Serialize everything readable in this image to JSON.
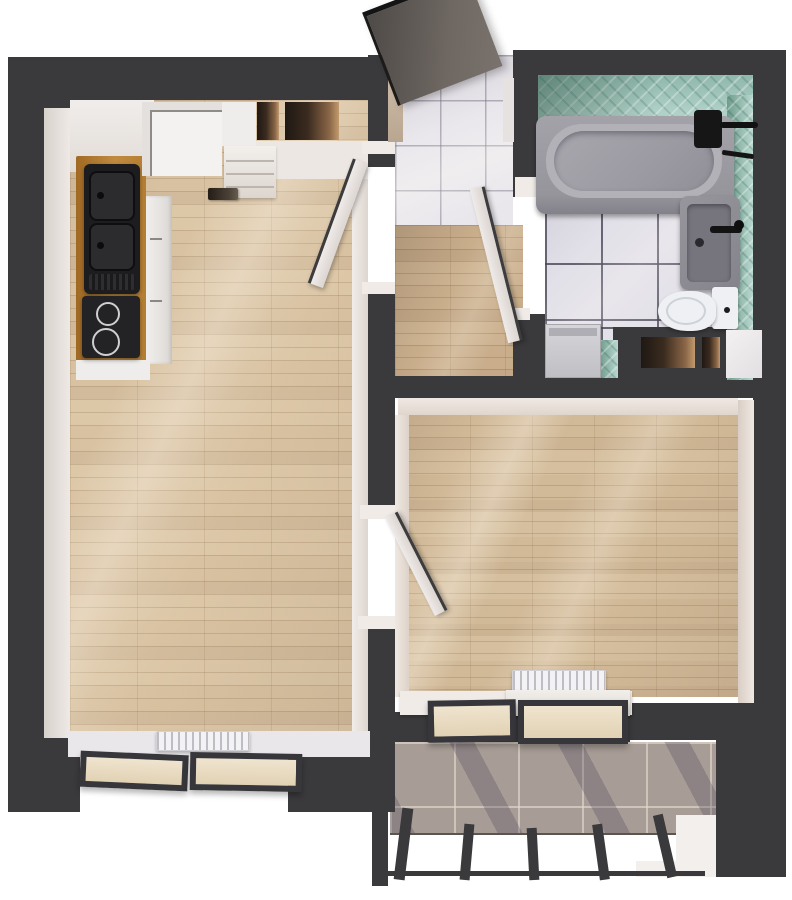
{
  "meta": {
    "title": "Apartment 3D floor plan render",
    "view": "top-down isometric render",
    "rooms": [
      {
        "id": "kitchen-living-room",
        "floor": "light oak planks"
      },
      {
        "id": "entry-hall",
        "floor": "light gray tile"
      },
      {
        "id": "corridor",
        "floor": "oak planks"
      },
      {
        "id": "bathroom",
        "floor": "white tile with dark grout",
        "walls": "teal diagonal mosaic"
      },
      {
        "id": "bedroom",
        "floor": "oak planks"
      },
      {
        "id": "balcony",
        "floor": "gray stone tile",
        "railing": "glass with dark posts"
      }
    ]
  },
  "palette": {
    "wall_dark": "#3a393b",
    "floor_wood": "#dcc7a8",
    "floor_wood_corridor": "#cdb392",
    "floor_wood_bedroom": "#d5bf9f",
    "tile_entry": "#e9e7ec",
    "tile_bath": "#e2e0e8",
    "tile_teal": "#9cc2b6",
    "tile_balcony": "#a89d96",
    "counter_wood": "#b5812f",
    "fixture_black": "#1d1d1f",
    "fixture_gray": "#8e8d94",
    "door_white": "#ece8e6",
    "entry_door_gray": "#5e5853",
    "radiator_white": "#f3f2f4"
  },
  "fixtures": {
    "kitchen": [
      "fridge",
      "tall-cabinet",
      "shoe-shelf",
      "wood-countertop",
      "double-sink-black",
      "cooktop-black",
      "cabinet-fronts",
      "floor-vent"
    ],
    "bathroom": [
      "bathtub",
      "shower-mixer-black",
      "washbasin-gray",
      "black-faucet",
      "toilet",
      "washing-machine",
      "wall-niche",
      "wall-niche-small"
    ],
    "living_room": [
      "radiator",
      "window-2-pane",
      "window-sill"
    ],
    "bedroom": [
      "radiator",
      "window-sill-box",
      "window-2-pane"
    ],
    "balcony": [
      "glass-railing",
      "railing-posts",
      "corner-ledge"
    ]
  },
  "doors": [
    {
      "id": "entry-door",
      "state": "open",
      "color": "dark-gray"
    },
    {
      "id": "living-room-door",
      "state": "open",
      "color": "white"
    },
    {
      "id": "bathroom-door",
      "state": "open",
      "color": "white"
    },
    {
      "id": "bedroom-door",
      "state": "open",
      "color": "white"
    }
  ]
}
